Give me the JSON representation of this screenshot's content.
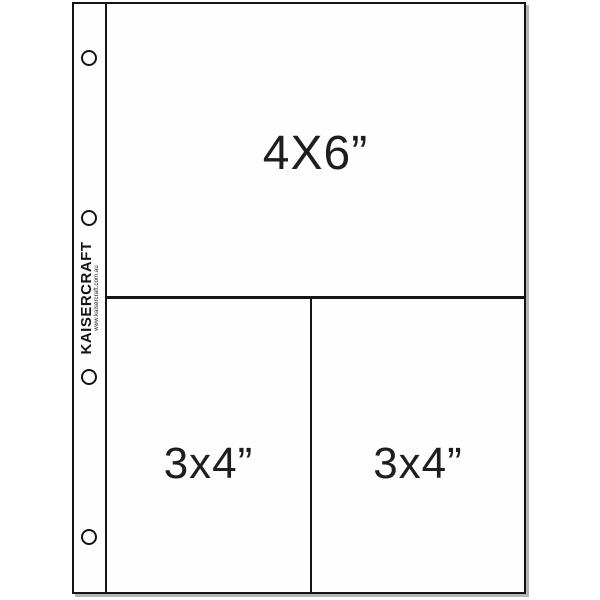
{
  "product": {
    "brand": "KAISERCRAFT",
    "website": "www.kaisercraft.com.au"
  },
  "pockets": {
    "large": {
      "label": "4X6”"
    },
    "bottom_left": {
      "label": "3x4”"
    },
    "bottom_right": {
      "label": "3x4”"
    }
  },
  "binder_holes": {
    "count": 4
  },
  "colors": {
    "background": "#ffffff",
    "line": "#141414",
    "label_text": "#1e1e1e",
    "shadow": "#b5b5b5"
  }
}
